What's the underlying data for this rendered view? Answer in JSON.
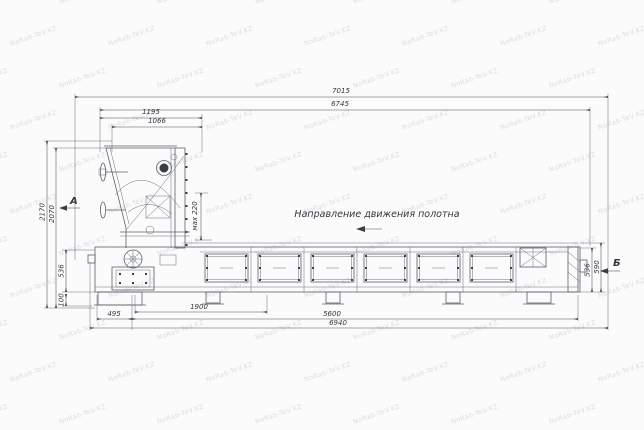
{
  "watermark": {
    "text": "NoRab-TeV.KZ"
  },
  "labels": {
    "direction": "Направление движения полотна",
    "view_a": "А",
    "view_b": "Б"
  },
  "dimensions": {
    "total_length": "7015",
    "inner_length": "6745",
    "head_width": "1195",
    "head_inner_width": "1066",
    "height_outer": "2170",
    "height_inner": "2070",
    "bed_height_left": "536",
    "foot_height": "100",
    "max_adjust": "мах 220",
    "foot_span": "495",
    "head_base_length": "1900",
    "bed_length": "5600",
    "base_total_length": "6940",
    "bed_height_right": "536",
    "right_outer_height": "590"
  }
}
